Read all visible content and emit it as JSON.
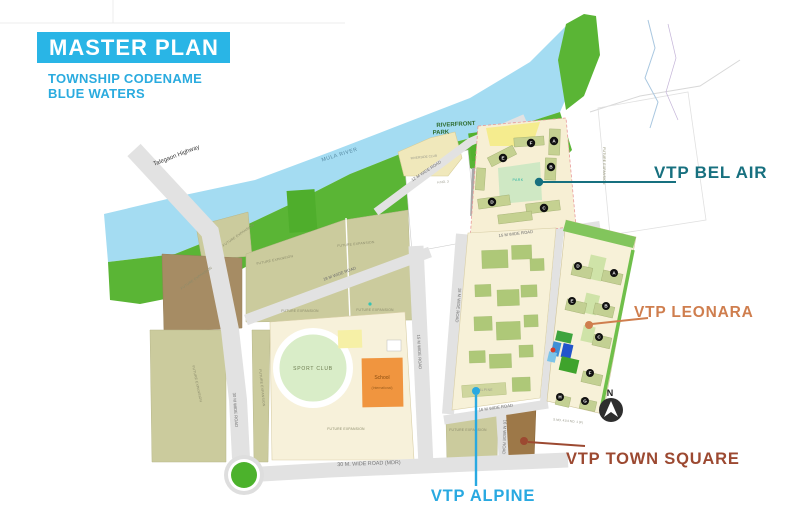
{
  "header": {
    "title": "MASTER PLAN",
    "subtitle1": "TOWNSHIP CODENAME",
    "subtitle2": "BLUE WATERS"
  },
  "callouts": {
    "bel_air": {
      "label": "VTP BEL AIR",
      "color": "#17707f"
    },
    "leonara": {
      "label": "VTP LEONARA",
      "color": "#cf7e4e"
    },
    "town_square": {
      "label": "VTP TOWN SQUARE",
      "color": "#9c4931"
    },
    "alpine": {
      "label": "VTP ALPINE",
      "color": "#29a9e1"
    }
  },
  "map": {
    "river": {
      "label": "MULA RIVER"
    },
    "highway": {
      "label": "Talegaon Highway"
    },
    "riverfront_park": {
      "line1": "RIVERFRONT",
      "line2": "PARK"
    },
    "riverside_club": {
      "label": "RIVERSIDE CLUB"
    },
    "sport_club": {
      "label": "SPORT CLUB"
    },
    "school": {
      "line1": "School",
      "line2": "(International)"
    },
    "park_label": "PARK",
    "alpine_parcel_label": "ALPINE",
    "future_expansion": "FUTURE EXPANSION",
    "north_label": "N",
    "survey": {
      "h_no": "H NO. 3",
      "sno_leonara": "S.NO. 41/4 NO. 1 (P)"
    },
    "roads": {
      "r30": "30 M WIDE ROAD",
      "r30_mdr": "30 M. WIDE ROAD (MDR)",
      "r15": "15 M WIDE ROAD",
      "r15_belair": "15 M WIDE ROAD",
      "r18": "18 M WIDE ROAD",
      "r18_alpine": "18 M WIDE ROAD",
      "r16": "16 M WIDE ROAD",
      "r16_v": "16 M WIDE ROAD",
      "r12": "12 M WIDE ROAD"
    },
    "bel_air_buildings": [
      "A",
      "B",
      "C",
      "D",
      "E",
      "F"
    ],
    "leonara_buildings": [
      "D",
      "A",
      "E",
      "B",
      "C",
      "F",
      "H",
      "G"
    ]
  }
}
